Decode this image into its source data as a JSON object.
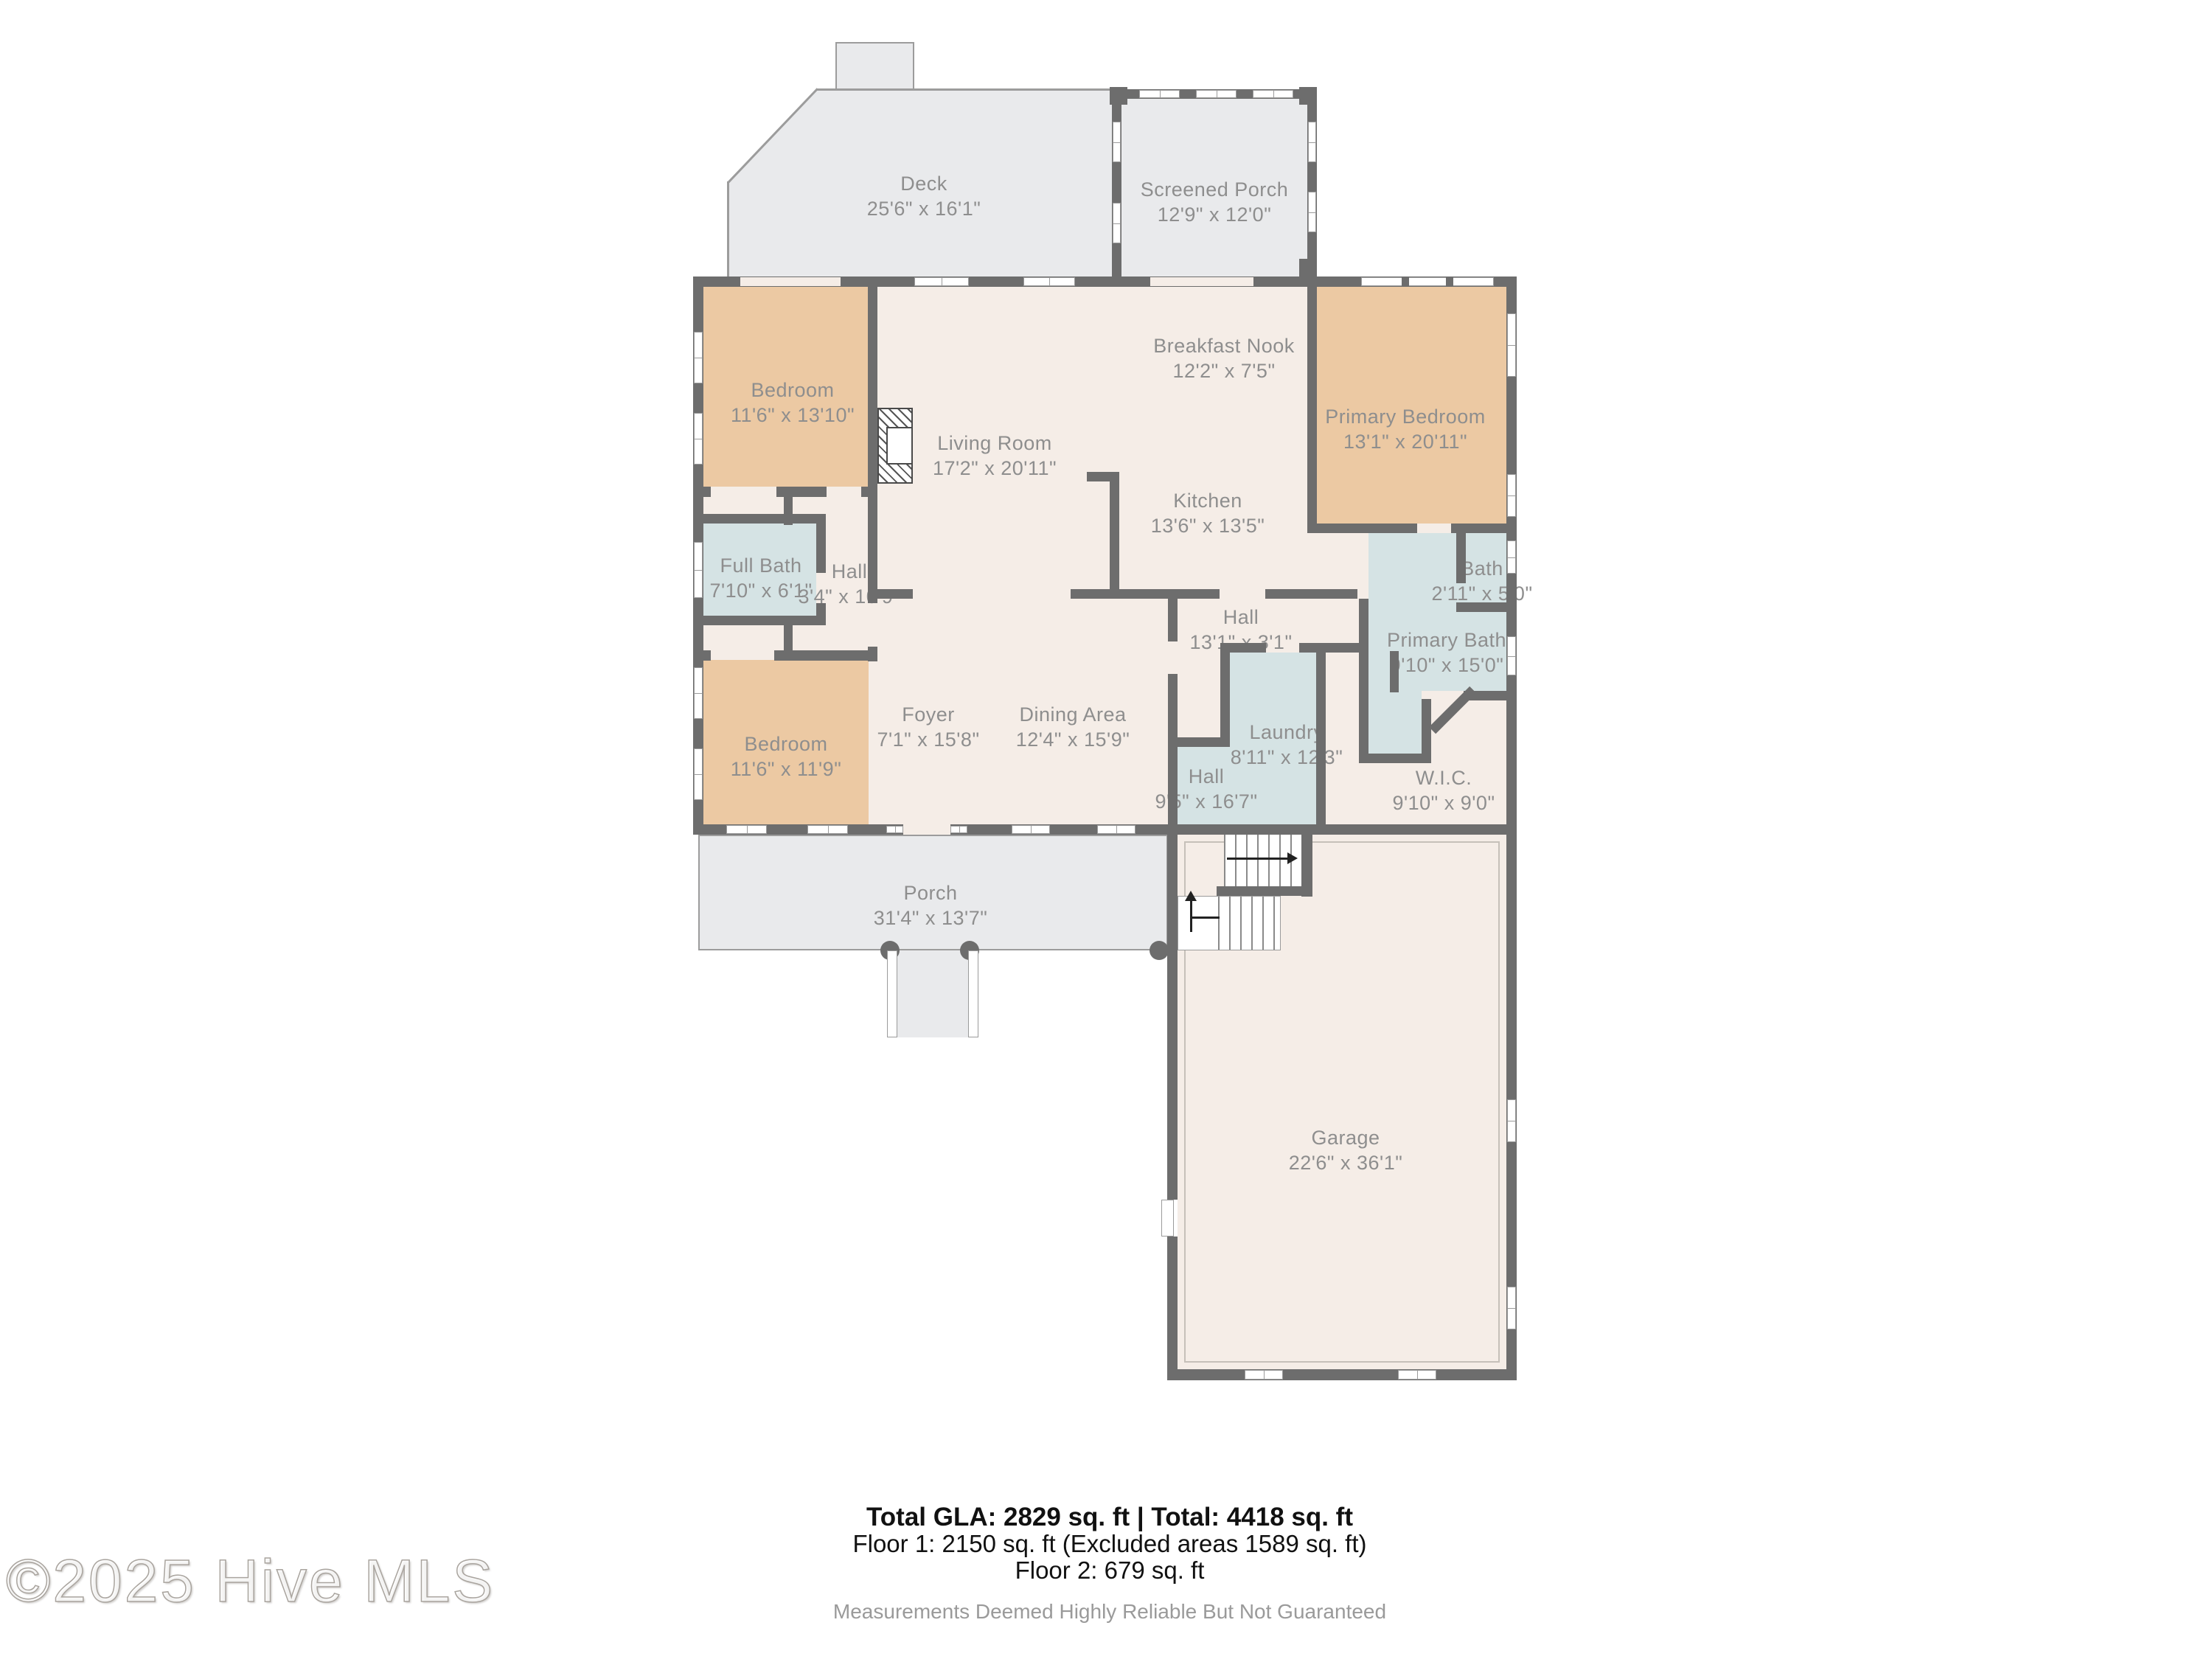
{
  "floorplan": {
    "rooms": {
      "deck": {
        "name": "Deck",
        "dims": "25'6\" x 16'1\""
      },
      "screened_porch": {
        "name": "Screened Porch",
        "dims": "12'9\" x 12'0\""
      },
      "bedroom_top": {
        "name": "Bedroom",
        "dims": "11'6\" x 13'10\""
      },
      "living_room": {
        "name": "Living Room",
        "dims": "17'2\" x 20'11\""
      },
      "breakfast_nook": {
        "name": "Breakfast Nook",
        "dims": "12'2\" x 7'5\""
      },
      "primary_bedroom": {
        "name": "Primary Bedroom",
        "dims": "13'1\" x 20'11\""
      },
      "kitchen": {
        "name": "Kitchen",
        "dims": "13'6\" x 13'5\""
      },
      "full_bath": {
        "name": "Full Bath",
        "dims": "7'10\" x 6'1\""
      },
      "hall_west": {
        "name": "Hall",
        "dims": "3'4\" x 10'9\""
      },
      "bath": {
        "name": "Bath",
        "dims": "2'11\" x 5'0\""
      },
      "primary_bath": {
        "name": "Primary Bath",
        "dims": "9'10\" x 15'0\""
      },
      "hall_center": {
        "name": "Hall",
        "dims": "13'1\" x 3'1\""
      },
      "laundry": {
        "name": "Laundry",
        "dims": "8'11\" x 12'3\""
      },
      "bedroom_bottom": {
        "name": "Bedroom",
        "dims": "11'6\" x 11'9\""
      },
      "foyer": {
        "name": "Foyer",
        "dims": "7'1\" x 15'8\""
      },
      "dining_area": {
        "name": "Dining Area",
        "dims": "12'4\" x 15'9\""
      },
      "hall_south": {
        "name": "Hall",
        "dims": "9'5\" x 16'7\""
      },
      "wic": {
        "name": "W.I.C.",
        "dims": "9'10\" x 9'0\""
      },
      "porch": {
        "name": "Porch",
        "dims": "31'4\" x 13'7\""
      },
      "garage": {
        "name": "Garage",
        "dims": "22'6\" x 36'1\""
      }
    },
    "summary": {
      "line1": "Total GLA: 2829 sq. ft | Total: 4418 sq. ft",
      "line2": "Floor 1: 2150 sq. ft (Excluded areas 1589 sq. ft)",
      "line3": "Floor 2: 679 sq. ft",
      "disclaimer": "Measurements Deemed Highly Reliable But Not Guaranteed"
    },
    "watermark": "©2025 Hive MLS",
    "colors": {
      "wall": "#6d6d6d",
      "floor": "#f5ede7",
      "bedroom_fill": "#ecc9a3",
      "bath_fill": "#d5e3e4",
      "outdoor_fill": "#e9eaec",
      "label_text": "#8e8e8e"
    }
  }
}
